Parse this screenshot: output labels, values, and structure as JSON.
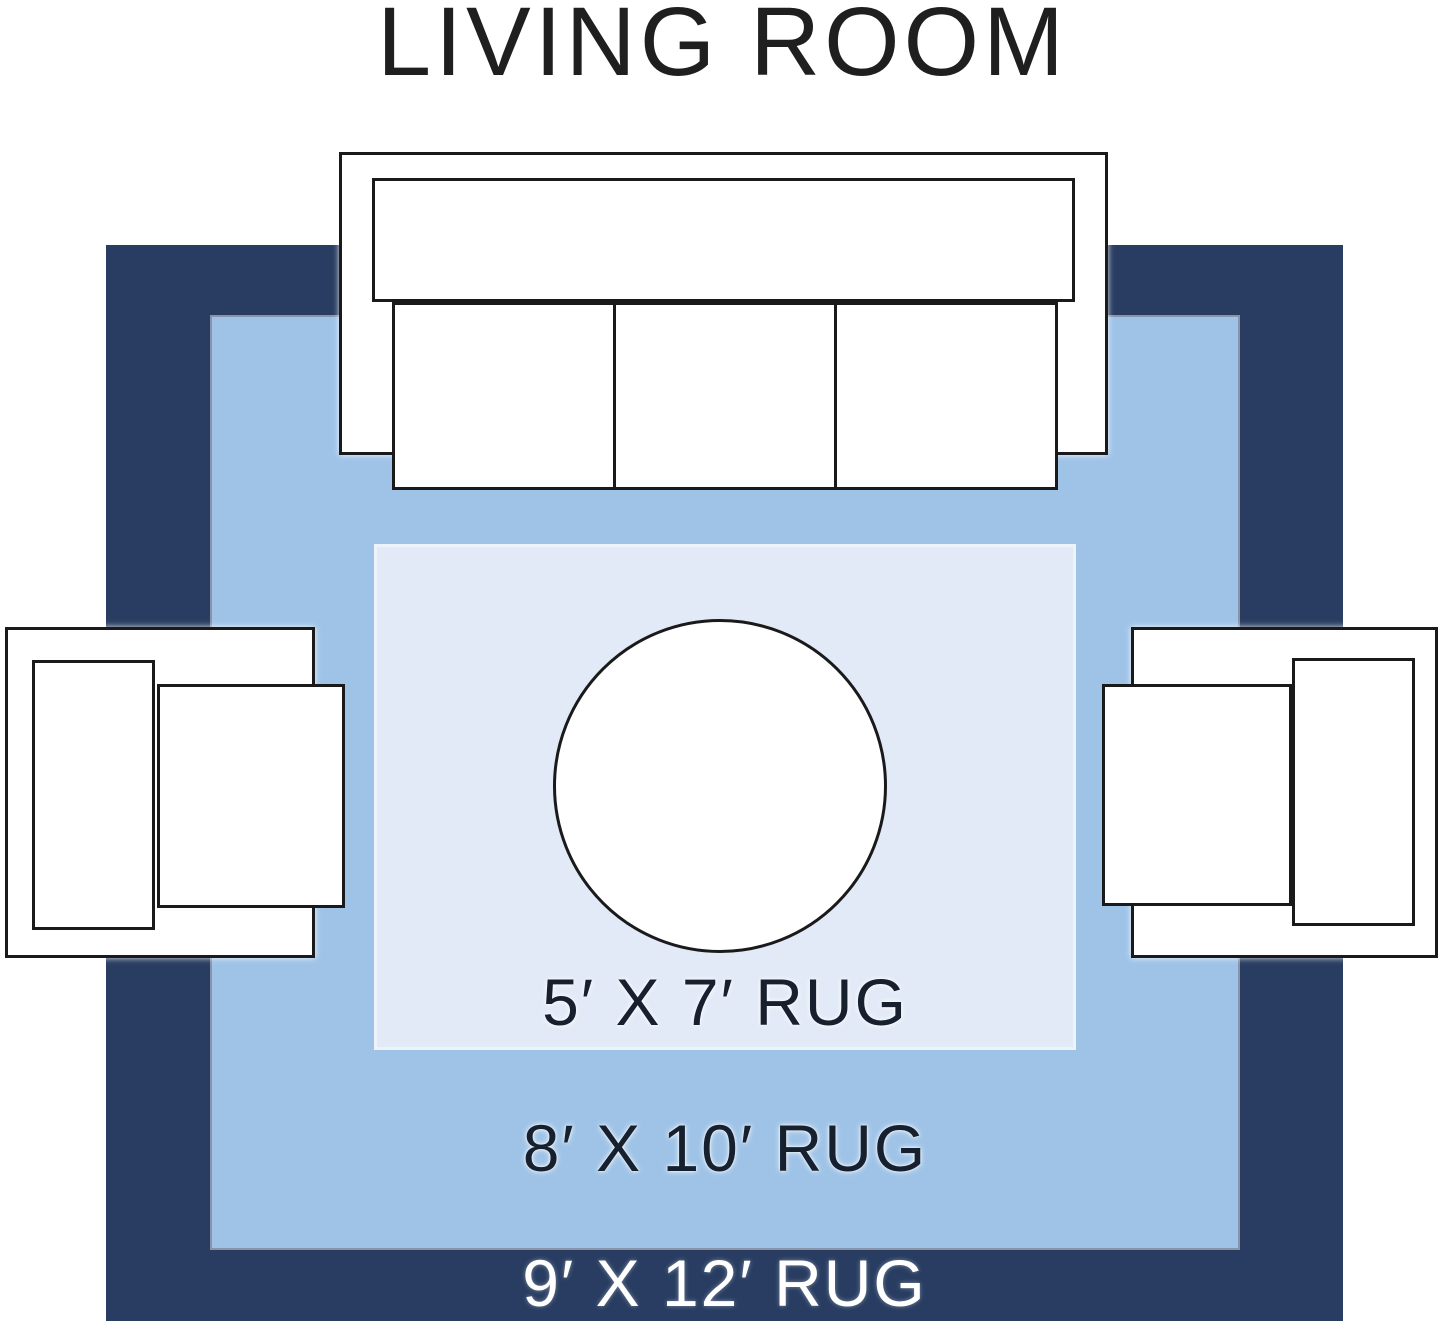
{
  "title": "LIVING ROOM",
  "rugs": {
    "r5x7": {
      "label": "5′ X 7′ RUG"
    },
    "r8x10": {
      "label": "8′ X 10′ RUG"
    },
    "r9x12": {
      "label": "9′ X 12′ RUG"
    }
  },
  "colors": {
    "bg": "#FFFFFF",
    "rug-9x12": "#283D61",
    "rug-8x10": "#9FC3E7",
    "rug-5x7": "#E2EAF7",
    "outline": "#1A1A1A",
    "title-text": "#1F1F1F",
    "label-dark": "#16202E",
    "label-light": "#FFFFFF",
    "furniture-fill": "#FFFFFF"
  }
}
